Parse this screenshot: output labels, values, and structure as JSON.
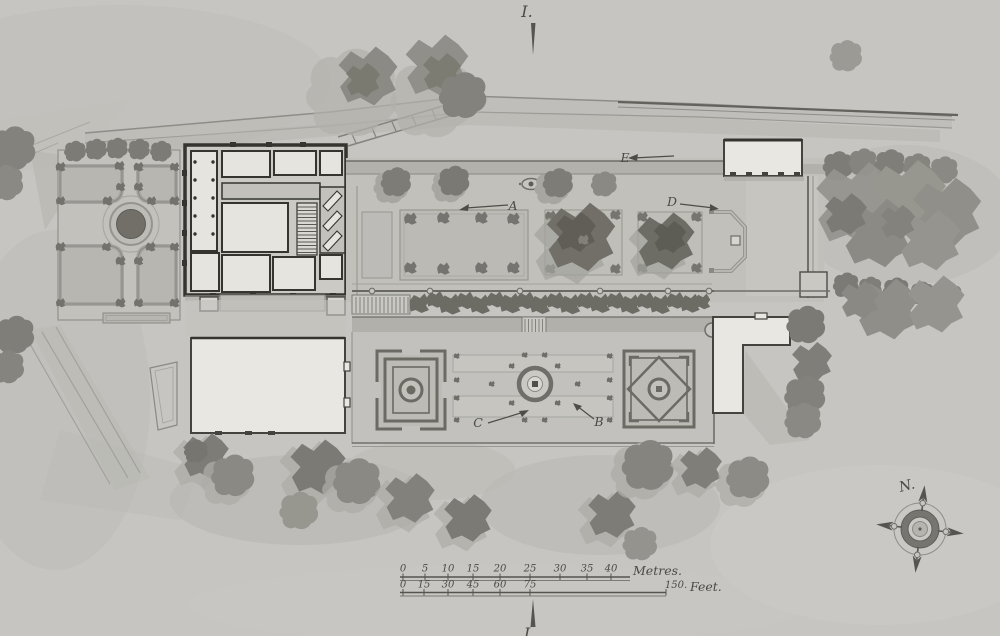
{
  "section_markers": {
    "top": "I.",
    "bottom": "I"
  },
  "labels": {
    "a": "A",
    "b": "B",
    "c": "C",
    "d": "D",
    "e": "E"
  },
  "compass": {
    "north_label": "N."
  },
  "scale_bar": {
    "metres": {
      "ticks": [
        "0",
        "5",
        "10",
        "15",
        "20",
        "25",
        "30",
        "35",
        "40"
      ],
      "unit_label": "Metres."
    },
    "feet": {
      "ticks": [
        "0",
        "15",
        "30",
        "45",
        "60",
        "75"
      ],
      "end_tick": "150.",
      "unit_label": "Feet."
    }
  },
  "colors": {
    "paper": "#c6c5c1",
    "ink": "#4e4d47",
    "wall_dark": "#35342e",
    "building_white": "#e9e7e2",
    "tree_mid": "#8b8a84",
    "tree_dark": "#6d6c65",
    "hedge": "#6c6b64",
    "wash": "#b2b1ac"
  }
}
